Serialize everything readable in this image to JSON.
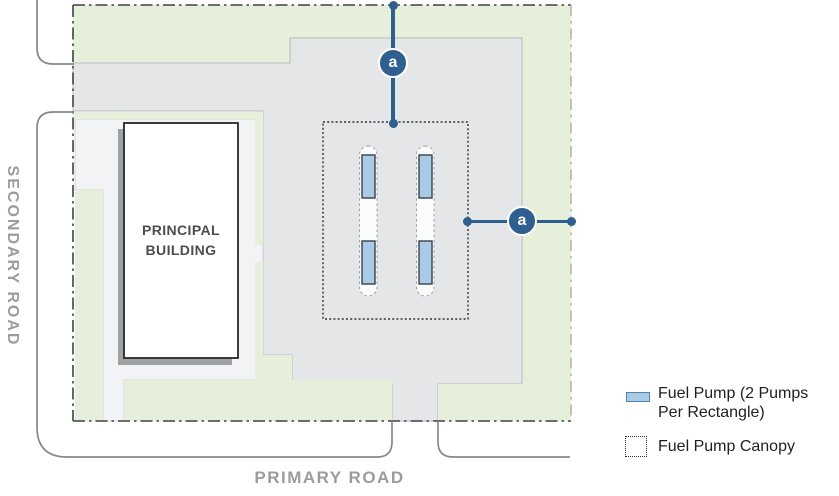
{
  "site_plan": {
    "building_label": "PRINCIPAL\nBUILDING",
    "secondary_road_label": "SECONDARY ROAD",
    "primary_road_label": "PRIMARY ROAD",
    "section_markers": {
      "top_label": "a",
      "right_label": "a"
    },
    "fuel_pump_rectangles_shown": 4
  },
  "legend": {
    "items": [
      {
        "swatch": "fuel-pump-swatch",
        "label": "Fuel Pump (2 Pumps\nPer Rectangle)"
      },
      {
        "swatch": "fuel-pump-canopy-swatch",
        "label": "Fuel Pump Canopy"
      }
    ]
  },
  "colors": {
    "landscape_green": "#e6efd9",
    "pavement_gray": "#e4e6e8",
    "walkway_gray": "#f2f3f4",
    "pump_blue": "#a9cbe5",
    "marker_blue": "#2d5f90",
    "road_label_gray": "#9a9da0",
    "property_line_dark": "#3f4144"
  }
}
